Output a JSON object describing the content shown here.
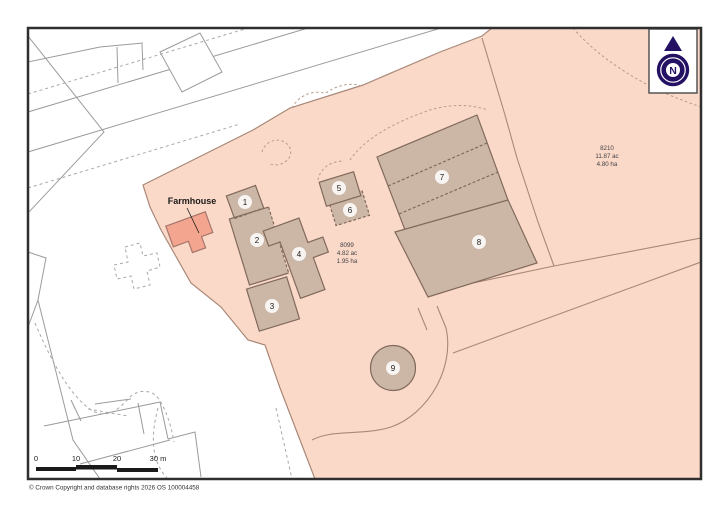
{
  "map": {
    "farmhouse_label": "Farmhouse",
    "buildings": [
      {
        "number": "1"
      },
      {
        "number": "2"
      },
      {
        "number": "3"
      },
      {
        "number": "4"
      },
      {
        "number": "5"
      },
      {
        "number": "6"
      },
      {
        "number": "7"
      },
      {
        "number": "8"
      },
      {
        "number": "9"
      }
    ],
    "parcels": [
      {
        "number": "8099",
        "area_acres": "4.82 ac",
        "area_hectares": "1.95 ha"
      },
      {
        "number": "8210",
        "area_acres": "11.87 ac",
        "area_hectares": "4.80 ha"
      }
    ]
  },
  "compass": {
    "label": "N"
  },
  "scale_bar": {
    "ticks": [
      "0",
      "10",
      "20",
      "30 m"
    ]
  },
  "footer": {
    "copyright": "© Crown Copyright and database rights 2026 OS 100004458"
  },
  "colors": {
    "parcel_pink": "#fbd9c8",
    "building_fill": "#ccb6a6",
    "building_outline": "#816a5c",
    "farmhouse_fill": "#f4a58f",
    "boundary_line": "#a98878",
    "compass_navy": "#251163",
    "frame": "#2f2f2f"
  }
}
